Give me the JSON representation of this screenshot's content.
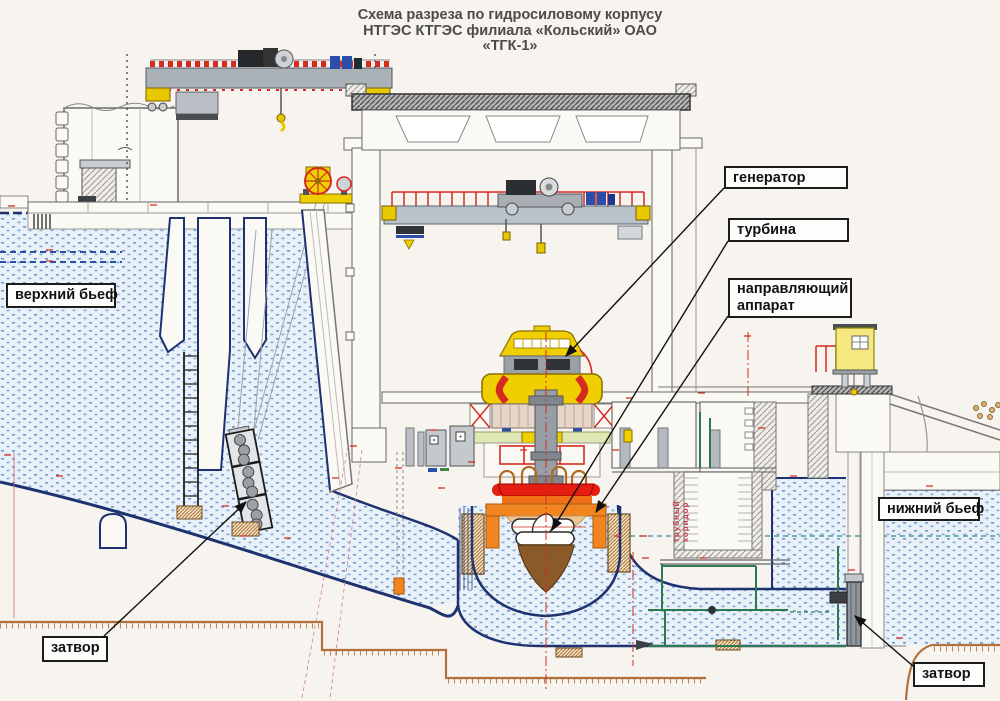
{
  "title": {
    "line1": "Схема разреза по гидросиловому корпусу",
    "line2": "НТГЭС КТГЭС филиала «Кольский» ОАО",
    "line3": "«ТГК-1»"
  },
  "labels": {
    "upper_pool": "верхний бьеф",
    "lower_pool": "нижний бьеф",
    "generator": "генератор",
    "turbine": "турбина",
    "guide_vanes": "направляющий аппарат",
    "gate_left": "затвор",
    "gate_right": "затвор",
    "pipe_corridor": "трубный коридор"
  },
  "colors": {
    "paper": "#f7f3ee",
    "water_dot": "#6e97cc",
    "outline_navy": "#1e3270",
    "machinery_yellow": "#f0cf00",
    "machinery_red": "#d42a20",
    "machinery_orange": "#f08522",
    "runner_brown": "#8a5a28",
    "ground_tan": "#b2713c",
    "pipe_green": "#2e7a50",
    "label_border": "#1c1c1c"
  }
}
